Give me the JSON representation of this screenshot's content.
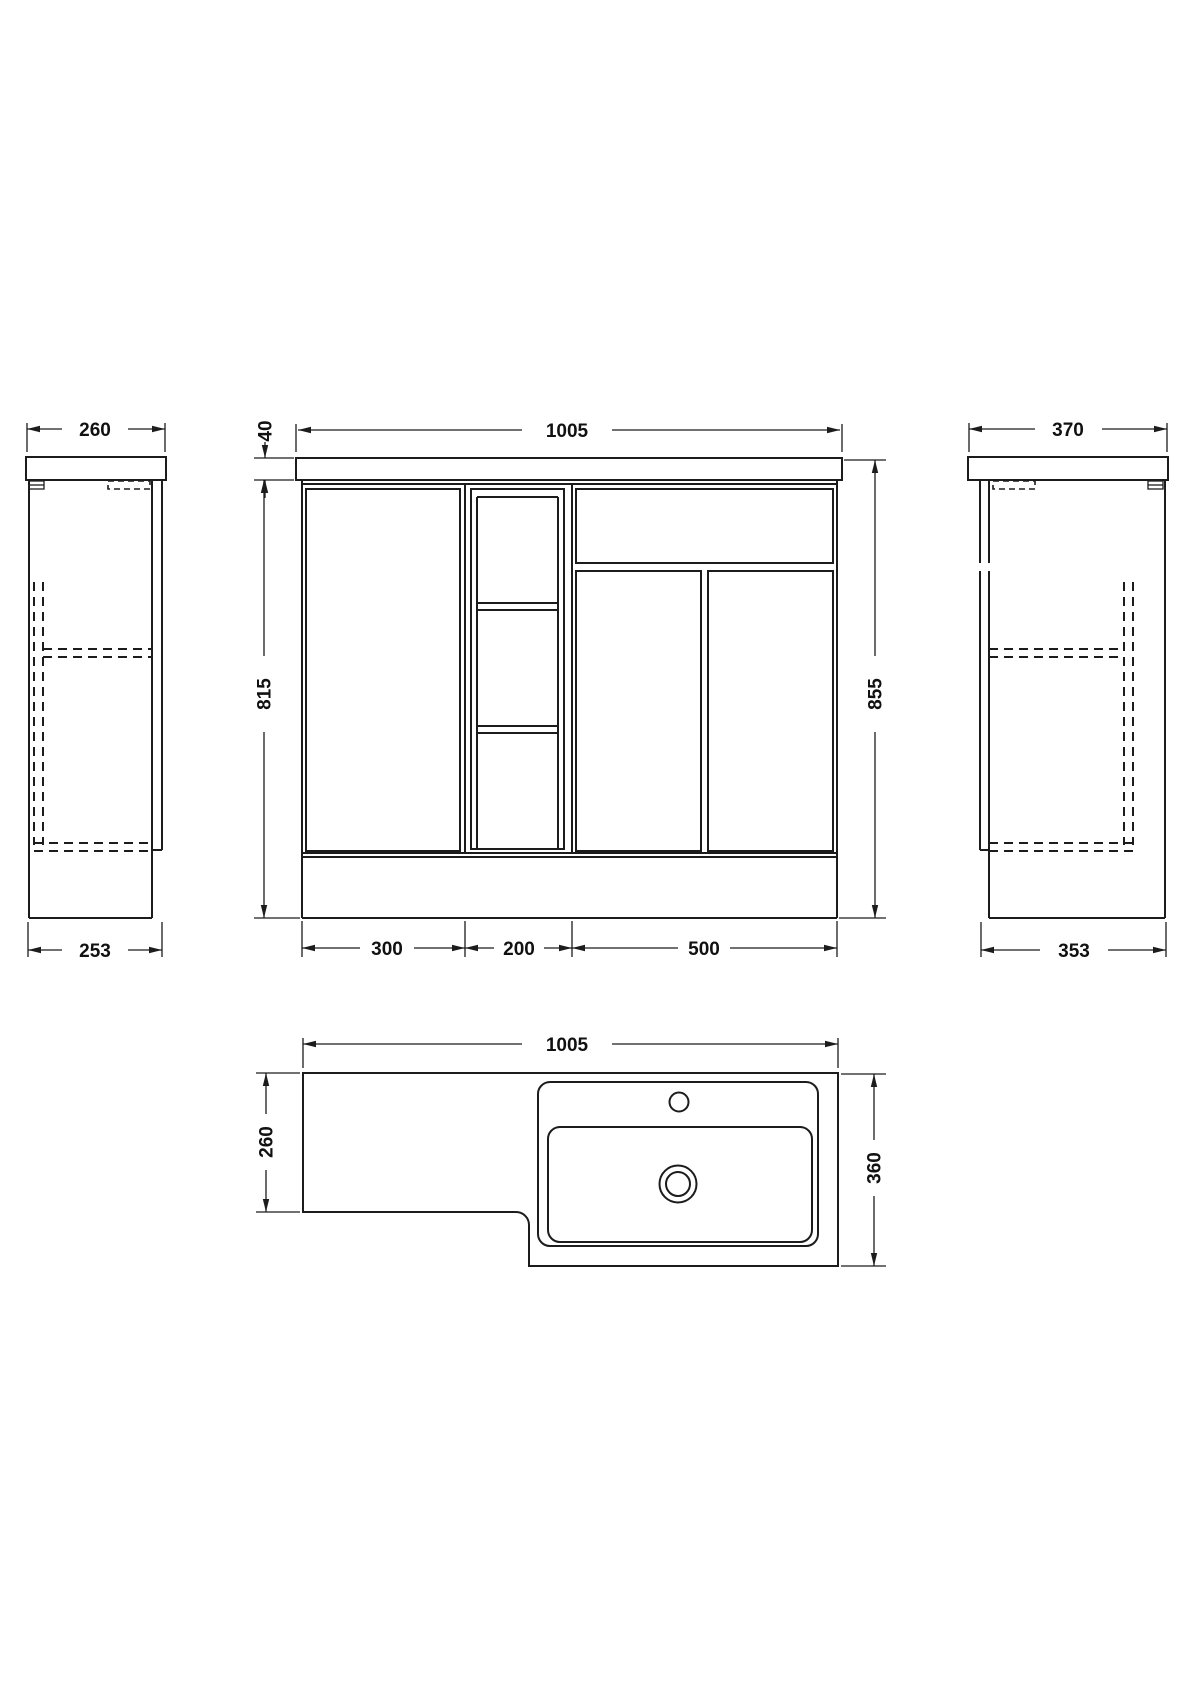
{
  "page": {
    "background": "#ffffff",
    "line_color": "#1c1c1c",
    "drawing_type": "furniture dimension drawing"
  },
  "views": {
    "side_left": {
      "top_width": "260",
      "bottom_depth": "253"
    },
    "front": {
      "overall_width": "1005",
      "worktop_thickness": "40",
      "cabinet_height": "815",
      "overall_height": "855",
      "section_left_width": "300",
      "section_middle_width": "200",
      "section_right_width": "500"
    },
    "side_right": {
      "top_width": "370",
      "bottom_depth": "353"
    },
    "plan": {
      "overall_width": "1005",
      "left_depth": "260",
      "right_depth": "360"
    }
  }
}
